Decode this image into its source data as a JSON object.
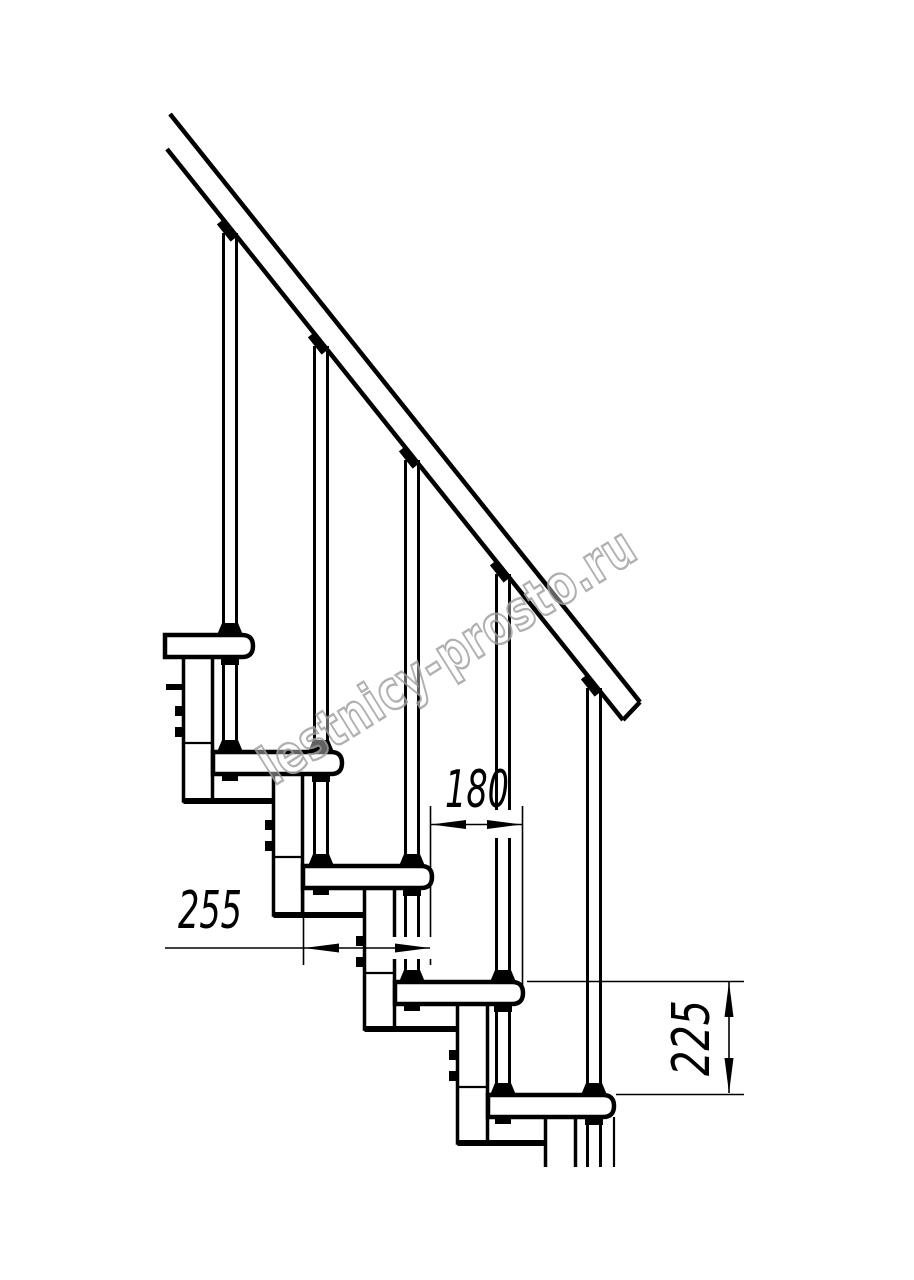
{
  "document": {
    "dimensions": {
      "step_run_mm": "180",
      "tread_depth_mm": "255",
      "step_rise_mm": "225"
    },
    "watermark": "lestnicy-prosto.ru",
    "colors": {
      "line": "#000000",
      "watermark_stroke": "#a3a3a3",
      "background": "#ffffff"
    }
  }
}
